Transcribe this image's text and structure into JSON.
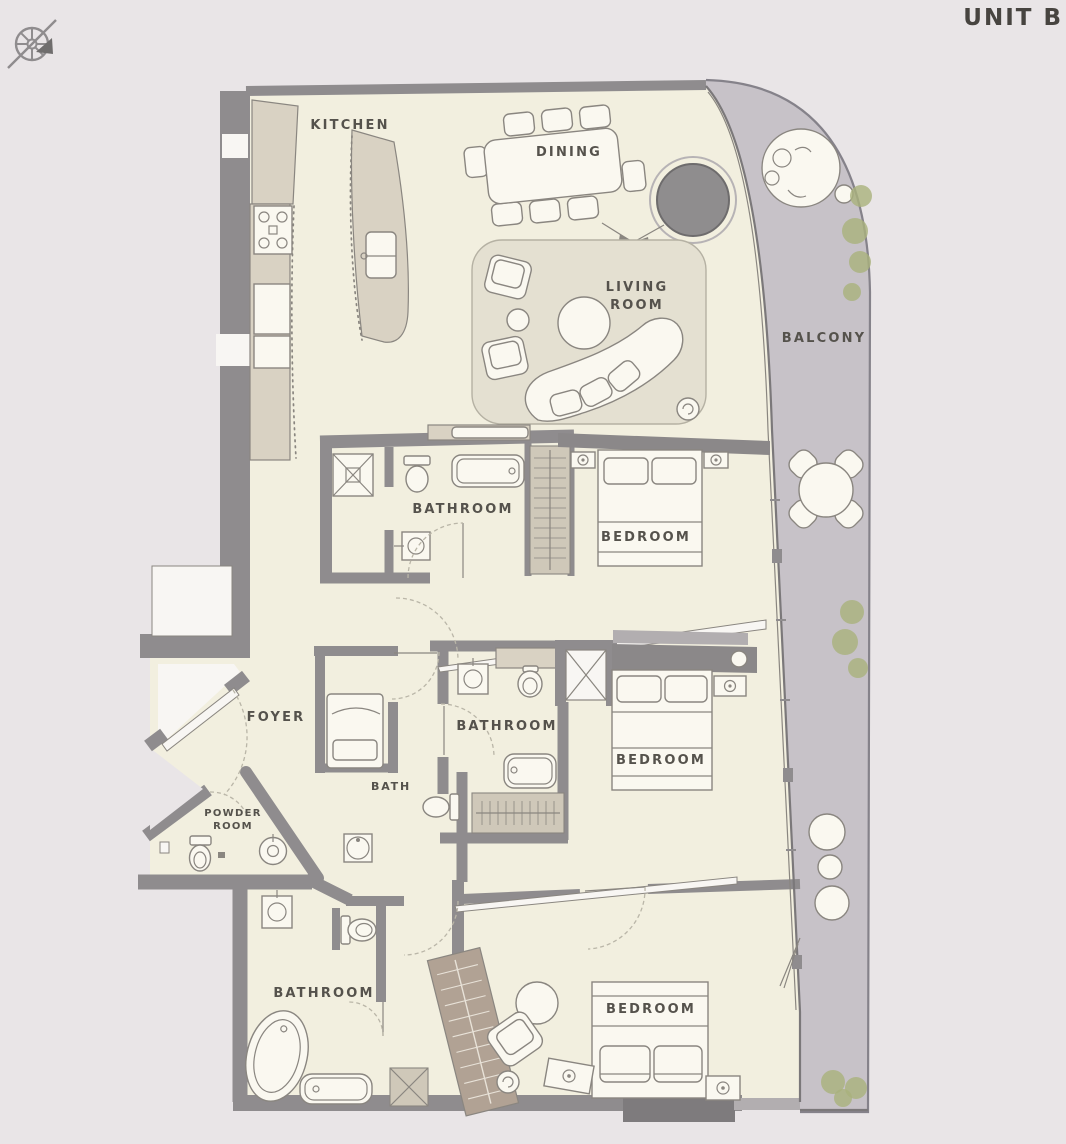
{
  "title": "UNIT B",
  "compass": {
    "icon": "compass-rose-arrow"
  },
  "rooms": {
    "kitchen": "KITCHEN",
    "dining": "DINING",
    "living1": "LIVING",
    "living2": "ROOM",
    "balcony": "BALCONY",
    "bathroom1": "BATHROOM",
    "bedroom1": "BEDROOM",
    "foyer": "FOYER",
    "bath": "BATH",
    "powder1": "POWDER",
    "powder2": "ROOM",
    "bathroom2": "BATHROOM",
    "bedroom2": "BEDROOM",
    "bathroom3": "BATHROOM",
    "bedroom3": "BEDROOM"
  },
  "colors": {
    "bg": "#e9e5e7",
    "floor": "#f2efdf",
    "wall": "#8f8c8e",
    "balcony": "#c7c2c8",
    "furn": "#faf8f0",
    "stroke": "#8a8680",
    "counter": "#d9d2c3",
    "rug": "#e4e0d1",
    "rugline": "#b5b1a3",
    "closet": "#cfc8b9",
    "wood": "#b1a294",
    "plant": "#a9b17c",
    "dark": "#8f8d8e",
    "darkwall": "#8b8889",
    "glass": "#7b787a",
    "white": "#f8f6f3",
    "text": "#55524c",
    "dashline": "#bab6a8",
    "title": "#474440",
    "lightwall": "#b2aeb0",
    "darkbump": "#7e7b7d"
  }
}
